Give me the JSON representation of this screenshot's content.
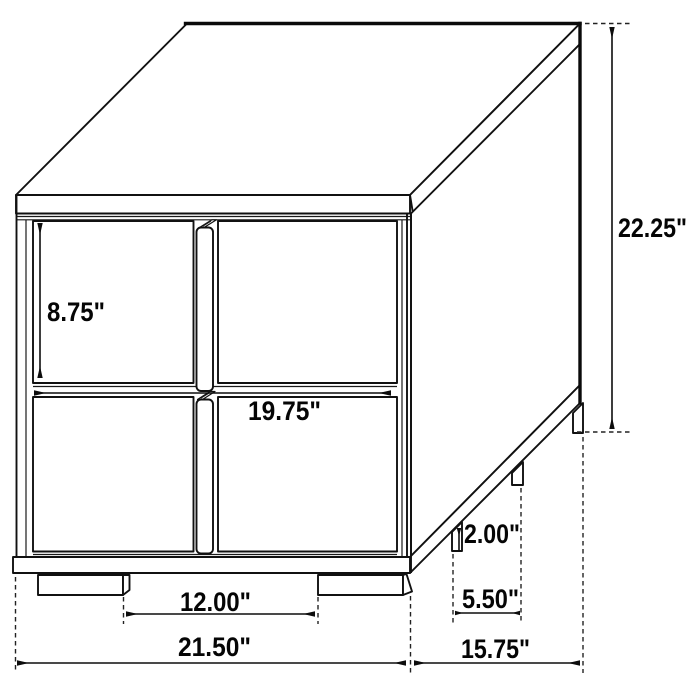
{
  "diagram": {
    "type": "furniture-dimension-drawing",
    "item": "two-drawer nightstand line drawing, isometric view",
    "unit": "inches",
    "background_color": "#ffffff",
    "line_color": "#111111",
    "labels": {
      "drawer_height": "8.75\"",
      "drawer_width": "19.75\"",
      "overall_height": "22.25\"",
      "leg_height": "2.00\"",
      "side_leg_gap": "5.50\"",
      "front_leg_gap": "12.00\"",
      "overall_width": "21.50\"",
      "overall_depth": "15.75\""
    }
  }
}
